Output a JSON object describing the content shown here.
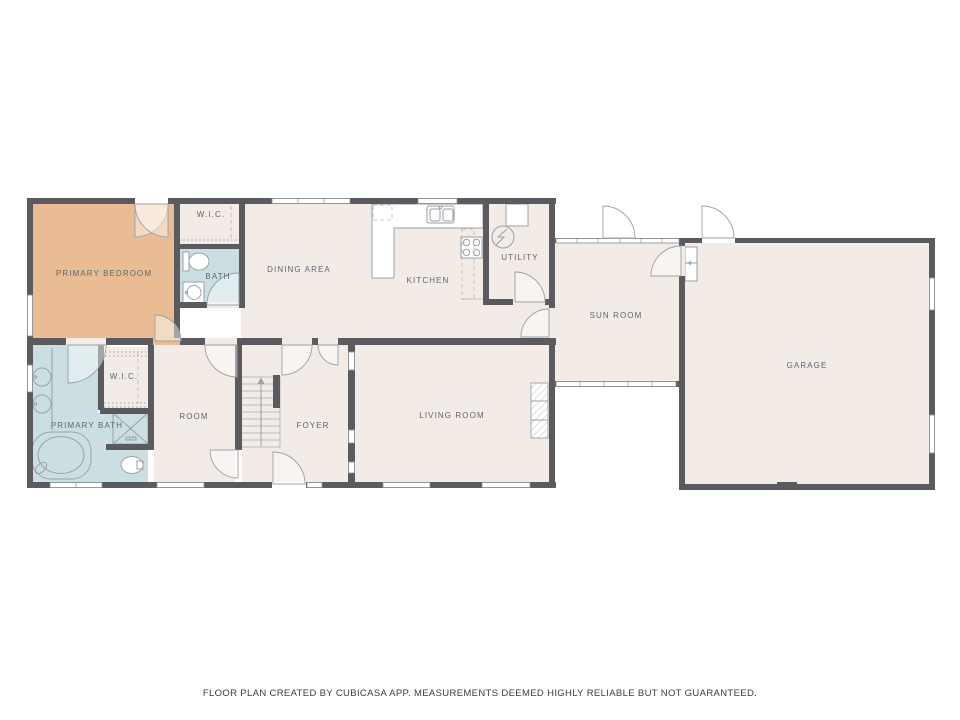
{
  "footer": {
    "disclaimer": "FLOOR PLAN CREATED BY CUBICASA APP. MEASUREMENTS DEEMED HIGHLY RELIABLE BUT NOT GUARANTEED."
  },
  "colors": {
    "wall": "#5a5a5f",
    "bedroom": "#eabc93",
    "bathroom": "#cbdfe2",
    "floor": "#f2ebe6",
    "fixture_line": "#9aa2a8",
    "label_text": "#5d6771",
    "footer_text": "#3c3c3c"
  },
  "rooms": [
    {
      "name": "primary-bedroom",
      "label": "PRIMARY BEDROOM"
    },
    {
      "name": "wic-upper",
      "label": "W.I.C."
    },
    {
      "name": "bath",
      "label": "BATH"
    },
    {
      "name": "dining-area",
      "label": "DINING AREA"
    },
    {
      "name": "kitchen",
      "label": "KITCHEN"
    },
    {
      "name": "utility",
      "label": "UTILITY"
    },
    {
      "name": "sun-room",
      "label": "SUN ROOM"
    },
    {
      "name": "garage",
      "label": "GARAGE"
    },
    {
      "name": "primary-bath",
      "label": "PRIMARY BATH"
    },
    {
      "name": "wic-lower",
      "label": "W.I.C."
    },
    {
      "name": "room",
      "label": "ROOM"
    },
    {
      "name": "foyer",
      "label": "FOYER"
    },
    {
      "name": "living-room",
      "label": "LIVING ROOM"
    }
  ]
}
